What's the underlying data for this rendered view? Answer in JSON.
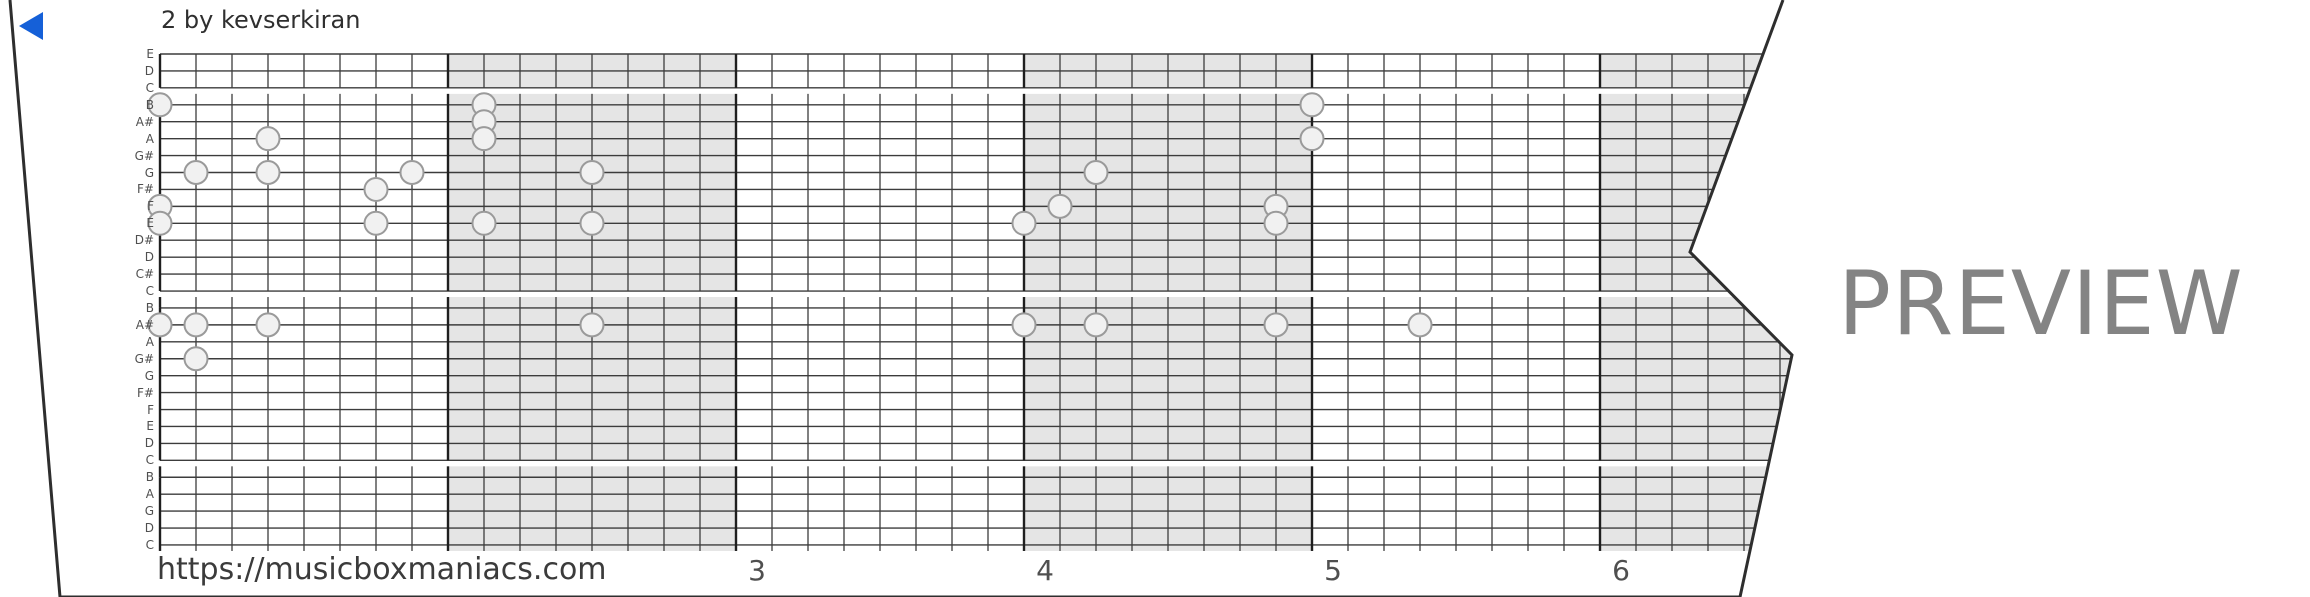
{
  "header": {
    "title": "2 by kevserkiran",
    "back_icon": "left-triangle",
    "accent_color": "#1560d8"
  },
  "footer": {
    "url": "https://musicboxmaniacs.com",
    "preview_watermark": "PREVIEW"
  },
  "colors": {
    "grid_line": "#3c3c3c",
    "measure_line": "#1f1f1f",
    "shaded_measure": "#e5e5e5",
    "note_fill": "#f1f1f1",
    "note_stroke": "#9a9a9a",
    "strip_border": "#2e2e2e",
    "watermark": "#848484",
    "label": "#4f4f4f"
  },
  "chart_data": {
    "type": "piano-roll",
    "title": "2 by kevserkiran",
    "row_labels": [
      "E",
      "D",
      "C",
      "B",
      "A#",
      "A",
      "G#",
      "G",
      "F#",
      "F",
      "E",
      "D#",
      "D",
      "C#",
      "C",
      "B",
      "A#",
      "A",
      "G#",
      "G",
      "F#",
      "F",
      "E",
      "D",
      "C",
      "B",
      "A",
      "G",
      "D",
      "C"
    ],
    "band_row_ranges": [
      [
        0,
        2
      ],
      [
        3,
        14
      ],
      [
        15,
        24
      ],
      [
        25,
        29
      ]
    ],
    "beats_per_measure": 8,
    "total_beat_columns": 47,
    "shaded_measure_indices": [
      1,
      3,
      5
    ],
    "visible_measure_numbers": [
      {
        "label": "3",
        "measure_index": 2
      },
      {
        "label": "4",
        "measure_index": 3
      },
      {
        "label": "5",
        "measure_index": 4
      },
      {
        "label": "6",
        "measure_index": 5
      }
    ],
    "notes": [
      {
        "col": 0,
        "row": 3,
        "note": "B"
      },
      {
        "col": 9,
        "row": 3,
        "note": "B"
      },
      {
        "col": 32,
        "row": 3,
        "note": "B"
      },
      {
        "col": 9,
        "row": 4,
        "note": "A#"
      },
      {
        "col": 3,
        "row": 5,
        "note": "A"
      },
      {
        "col": 9,
        "row": 5,
        "note": "A"
      },
      {
        "col": 32,
        "row": 5,
        "note": "A"
      },
      {
        "col": 1,
        "row": 7,
        "note": "G"
      },
      {
        "col": 3,
        "row": 7,
        "note": "G"
      },
      {
        "col": 7,
        "row": 7,
        "note": "G"
      },
      {
        "col": 12,
        "row": 7,
        "note": "G"
      },
      {
        "col": 26,
        "row": 7,
        "note": "G"
      },
      {
        "col": 6,
        "row": 8,
        "note": "F#"
      },
      {
        "col": 0,
        "row": 9,
        "note": "F"
      },
      {
        "col": 25,
        "row": 9,
        "note": "F"
      },
      {
        "col": 31,
        "row": 9,
        "note": "F"
      },
      {
        "col": 0,
        "row": 10,
        "note": "E"
      },
      {
        "col": 6,
        "row": 10,
        "note": "E"
      },
      {
        "col": 9,
        "row": 10,
        "note": "E"
      },
      {
        "col": 12,
        "row": 10,
        "note": "E"
      },
      {
        "col": 24,
        "row": 10,
        "note": "E"
      },
      {
        "col": 31,
        "row": 10,
        "note": "E"
      },
      {
        "col": 0,
        "row": 16,
        "note": "A#"
      },
      {
        "col": 1,
        "row": 16,
        "note": "A#"
      },
      {
        "col": 3,
        "row": 16,
        "note": "A#"
      },
      {
        "col": 12,
        "row": 16,
        "note": "A#"
      },
      {
        "col": 24,
        "row": 16,
        "note": "A#"
      },
      {
        "col": 26,
        "row": 16,
        "note": "A#"
      },
      {
        "col": 31,
        "row": 16,
        "note": "A#"
      },
      {
        "col": 35,
        "row": 16,
        "note": "A#"
      },
      {
        "col": 1,
        "row": 18,
        "note": "G#"
      }
    ]
  },
  "layout_values": {
    "grid_left": 160,
    "col_pitch": 36,
    "row_top": 54,
    "row_pitch": 16.93,
    "strip_polygon": [
      [
        10,
        0
      ],
      [
        1783,
        0
      ],
      [
        1690,
        252
      ],
      [
        1792,
        355
      ],
      [
        1740,
        597
      ],
      [
        60,
        597
      ]
    ]
  }
}
